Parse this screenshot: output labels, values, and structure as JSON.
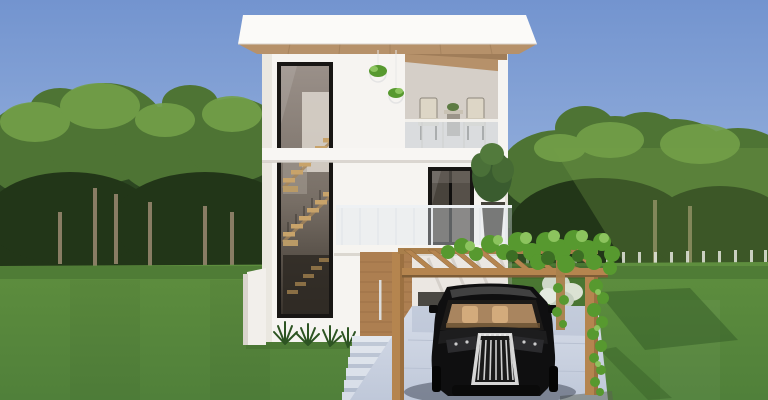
{
  "scene": {
    "type": "3d-architectural-render",
    "description": "3D exterior rendering of a modern white three-story house with a tall staircase window, upper terrace with chairs, wooden pergola carport covered in vines sheltering a black SUV, green lawn and forest backdrop under a blue sky.",
    "objects": {
      "sky": "blue sky",
      "forest": "pine forest backdrop",
      "lawn": "green lawn",
      "house": "modern white house",
      "roof": "flat roof slab with wooden soffit",
      "stair_window": "tall glazed staircase window",
      "staircase": "interior wooden staircase",
      "balcony": "recessed roof terrace with outdoor chairs and table",
      "hanging_plants": "hanging plant baskets",
      "sliding_door": "black framed sliding glass door",
      "potted_plant": "potted tree on balcony",
      "balustrade": "frameless glass balustrade",
      "front_door": "wooden entry door with long pull handle",
      "steps": "entry steps",
      "pergola": "wooden pergola carport",
      "vines": "climbing vine foliage",
      "driveway": "concrete driveway",
      "car": "black SUV parked under pergola",
      "shrubs": "ornamental grasses and shrubs",
      "fence": "low white fence posts at tree line"
    }
  },
  "palette": {
    "sky_top": "#7394cf",
    "sky_horizon": "#a3bce2",
    "tree_mid": "#4e7434",
    "tree_light": "#73a049",
    "tree_dark": "#2c4621",
    "tree_shade": "#223618",
    "trunk": "#9c8a72",
    "lawn_top": "#5e8e3e",
    "lawn_bottom": "#50803a",
    "lawn_shadow": "#375f28",
    "house_white": "#f6f4f1",
    "house_shade": "#e2ddd6",
    "roof_white": "#fbfaf8",
    "soffit_wood": "#b6916a",
    "pergola_wood": "#b5854f",
    "pergola_wood_dark": "#8a6339",
    "door_wood": "#ad7f51",
    "stair_wood": "#c8a36a",
    "frame_dark": "#181614",
    "glass_top": "#9a9089",
    "glass_bottom": "#3a342d",
    "railing_glass": "#dfe8f0",
    "driveway_light": "#d6dce8",
    "driveway_dark": "#bfc8d9",
    "car_body": "#0f0f10",
    "car_interior": "#c2996c",
    "chrome": "#d6d6d6",
    "vine_green": "#57992f",
    "vine_light": "#8cc45e",
    "vine_dark": "#3c6e24",
    "fence_white": "#e3e6dd"
  }
}
